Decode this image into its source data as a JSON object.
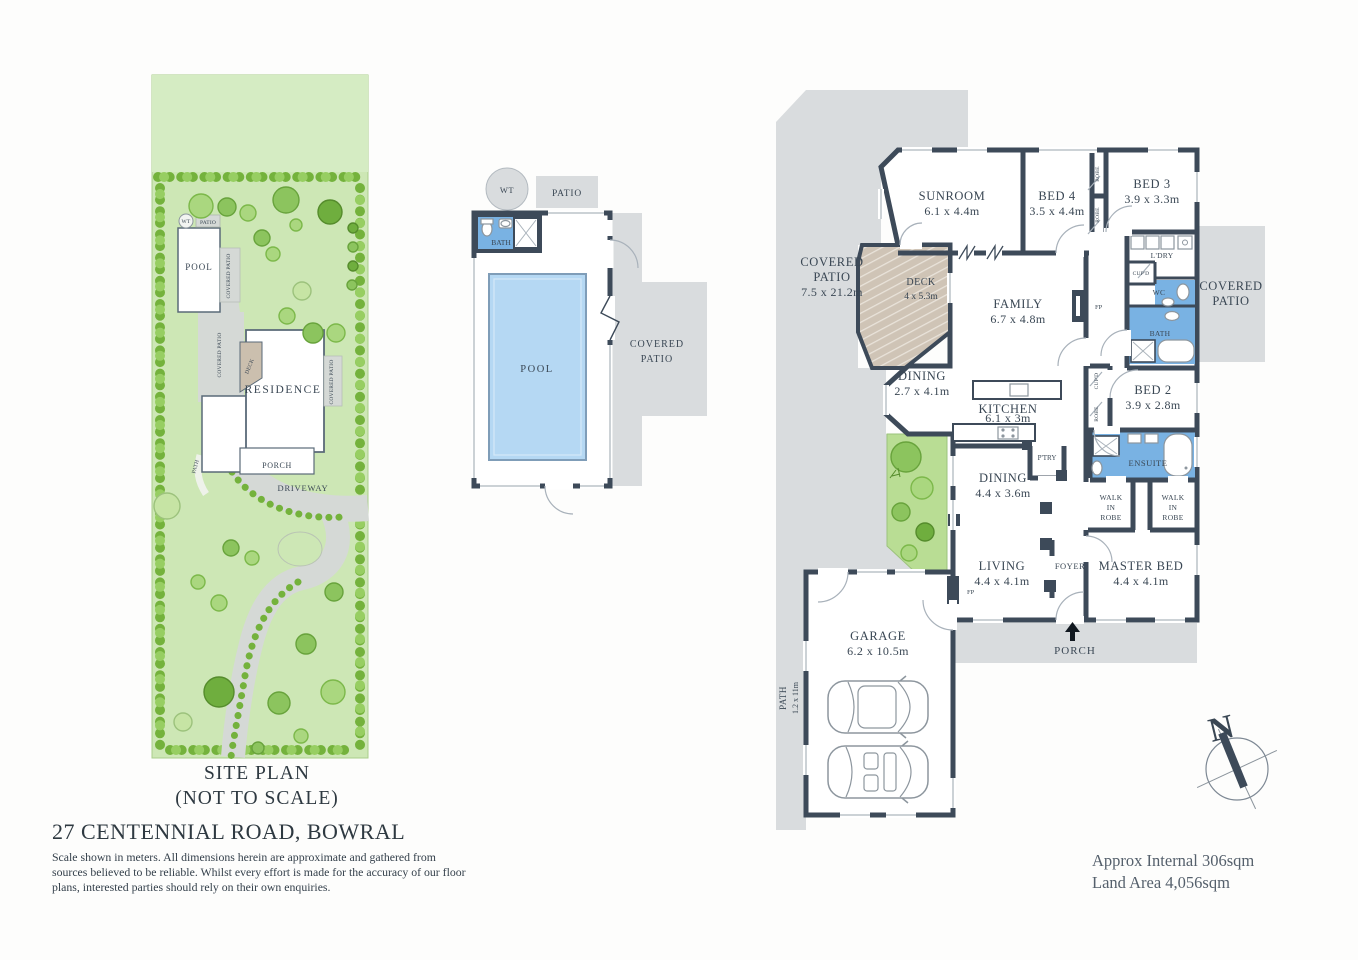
{
  "site": {
    "title": "SITE PLAN",
    "subtitle": "(NOT TO SCALE)",
    "labels": {
      "wt": "WT",
      "patio": "PATIO",
      "pool": "POOL",
      "covered_patio": "COVERED PATIO",
      "deck": "DECK",
      "residence": "RESIDENCE",
      "covered_patio_right": "COVERED PATIO",
      "path": "PATH",
      "porch": "PORCH",
      "driveway": "DRIVEWAY"
    }
  },
  "pool_plan": {
    "labels": {
      "wt": "WT",
      "patio": "PATIO",
      "bath": "BATH",
      "pool": "POOL",
      "covered_l1": "COVERED",
      "covered_l2": "PATIO"
    }
  },
  "floor_plan": {
    "covered_patio_left": {
      "l1": "COVERED",
      "l2": "PATIO",
      "dims": "7.5 x 21.2m"
    },
    "sunroom": {
      "name": "SUNROOM",
      "dims": "6.1 x 4.4m"
    },
    "bed4": {
      "name": "BED 4",
      "dims": "3.5 x 4.4m"
    },
    "bed3": {
      "name": "BED 3",
      "dims": "3.9 x 3.3m"
    },
    "robe": "ROBE",
    "ldry": "L'DRY",
    "cupd": "CUP'D",
    "wc": "WC",
    "bath": "BATH",
    "deck": {
      "name": "DECK",
      "dims": "4 x 5.3m"
    },
    "family": {
      "name": "FAMILY",
      "dims": "6.7 x 4.8m"
    },
    "fp": "FP",
    "covered_patio_right": {
      "l1": "COVERED",
      "l2": "PATIO"
    },
    "dining_bay": {
      "name": "DINING",
      "dims": "2.7 x 4.1m"
    },
    "kitchen": {
      "name": "KITCHEN",
      "dims": "6.1 x 3m"
    },
    "ptry": "P'TRY",
    "bed2": {
      "name": "BED 2",
      "dims": "3.9 x 2.8m"
    },
    "ensuite": "ENSUITE",
    "dining": {
      "name": "DINING",
      "dims": "4.4 x 3.6m"
    },
    "walk_in_robe": {
      "l1": "WALK",
      "l2": "IN",
      "l3": "ROBE"
    },
    "living": {
      "name": "LIVING",
      "dims": "4.4 x 4.1m"
    },
    "foyer": "FOYER",
    "master": {
      "name": "MASTER BED",
      "dims": "4.4 x 4.1m"
    },
    "porch": "PORCH",
    "garage": {
      "name": "GARAGE",
      "dims": "6.2 x 10.5m"
    },
    "path": {
      "name": "PATH",
      "dims": "1.2 x 11m"
    }
  },
  "footer": {
    "address": "27 CENTENNIAL ROAD, BOWRAL",
    "disclaimer1": "Scale shown in meters. All dimensions herein are approximate and gathered from",
    "disclaimer2": "sources believed to be  reliable. Whilst every effort is made for the accuracy of our floor",
    "disclaimer3": "plans, interested parties should rely on their own enquiries.",
    "internal_area": "Approx Internal 306sqm",
    "land_area": "Land Area 4,056sqm",
    "north": "N"
  },
  "colors": {
    "wall": "#3d4a59",
    "patio": "#d9dcde",
    "water": "#b5d8f3",
    "wet_area": "#79b2e3",
    "grass": "#cde7b5",
    "deck": "#cfc4b6"
  }
}
